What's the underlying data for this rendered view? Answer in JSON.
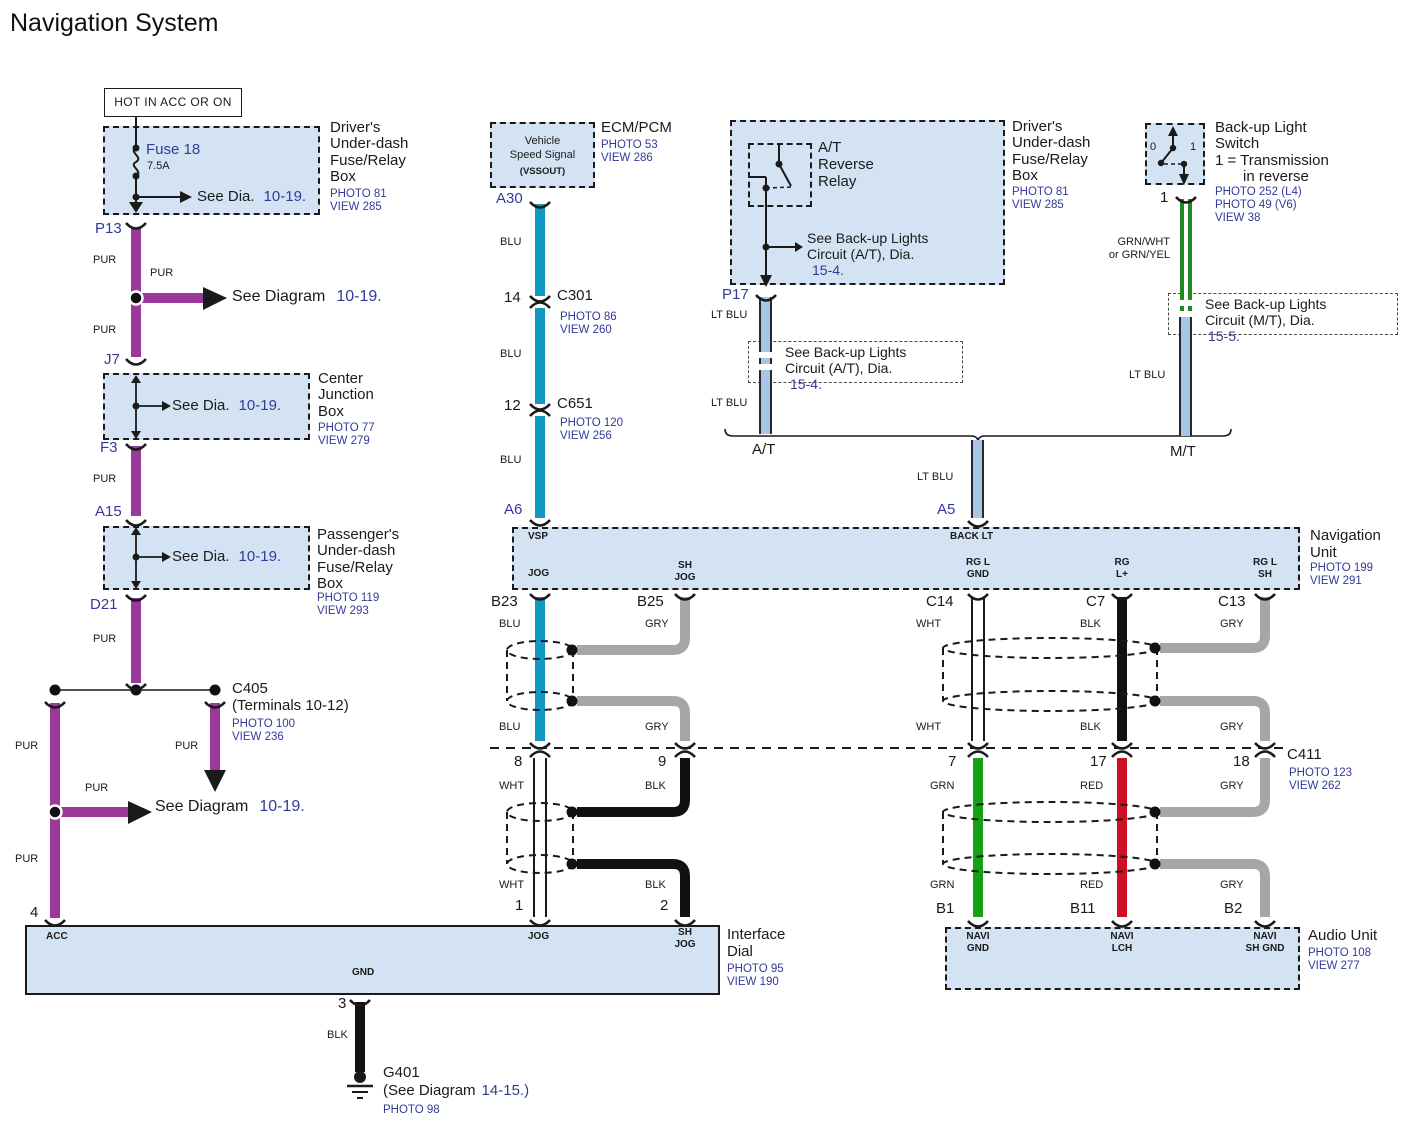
{
  "title": "Navigation System",
  "colors": {
    "box_fill": "#d4e3f3",
    "wire_pur": "#993a9b",
    "wire_blu": "#1099c2",
    "wire_lt_blu": "#a9c6e8",
    "wire_gry": "#a6a6a6",
    "wire_grn": "#16a016",
    "wire_grn_dbl": "#1e8c1e",
    "wire_red": "#cc1122",
    "wire_blk": "#111111",
    "text_blue": "#333a99"
  },
  "wire": {
    "pur": "PUR",
    "blu": "BLU",
    "lt_blu": "LT BLU",
    "gry": "GRY",
    "wht": "WHT",
    "blk": "BLK",
    "grn": "GRN",
    "red": "RED",
    "grn_wht": "GRN/WHT",
    "or_grn_yel": "or GRN/YEL"
  },
  "refs": {
    "see_dia": "See Dia.",
    "see_diagram": "See Diagram",
    "dia_10_19": "10-19.",
    "see_backup": "See Back-up Lights",
    "circuit_at": "Circuit (A/T), Dia.",
    "dia_15_4": "15-4.",
    "circuit_mt": "Circuit (M/T), Dia.",
    "dia_15_5": "15-5."
  },
  "hot": {
    "label": "HOT IN ACC OR ON"
  },
  "fuse": {
    "name": "Fuse 18",
    "rating": "7.5A"
  },
  "driver_box": {
    "l1": "Driver's",
    "l2": "Under-dash",
    "l3": "Fuse/Relay",
    "l4": "Box",
    "photo": "PHOTO 81",
    "view": "VIEW 285"
  },
  "cjb": {
    "l1": "Center",
    "l2": "Junction",
    "l3": "Box",
    "photo": "PHOTO 77",
    "view": "VIEW 279"
  },
  "pass_box": {
    "l1": "Passenger's",
    "l2": "Under-dash",
    "l3": "Fuse/Relay",
    "l4": "Box",
    "photo": "PHOTO 119",
    "view": "VIEW 293"
  },
  "c405": {
    "name": "C405",
    "terms": "(Terminals 10-12)",
    "photo": "PHOTO 100",
    "view": "VIEW 236"
  },
  "vss": {
    "l1": "Vehicle",
    "l2": "Speed Signal",
    "l3": "(VSSOUT)"
  },
  "ecm": {
    "name": "ECM/PCM",
    "photo": "PHOTO 53",
    "view": "VIEW 286"
  },
  "c301": {
    "name": "C301",
    "photo": "PHOTO 86",
    "view": "VIEW 260"
  },
  "c651": {
    "name": "C651",
    "photo": "PHOTO 120",
    "view": "VIEW 256"
  },
  "at_relay": {
    "l1": "A/T",
    "l2": "Reverse",
    "l3": "Relay"
  },
  "bls": {
    "l1": "Back-up Light",
    "l2": "Switch",
    "l3": "1 = Transmission",
    "l4": "in reverse",
    "photo1": "PHOTO 252 (L4)",
    "photo2": "PHOTO 49 (V6)",
    "view": "VIEW 38",
    "pos0": "0",
    "pos1": "1"
  },
  "trans": {
    "at": "A/T",
    "mt": "M/T"
  },
  "nav": {
    "l1": "Navigation",
    "l2": "Unit",
    "photo": "PHOTO 199",
    "view": "VIEW 291",
    "vsp": "VSP",
    "jog": "JOG",
    "sh": "SH",
    "sh_jog": "JOG",
    "back_lt": "BACK LT",
    "rg_l": "RG L",
    "gnd": "GND",
    "rg": "RG",
    "l_plus": "L+",
    "sh_r": "SH"
  },
  "c411": {
    "name": "C411",
    "photo": "PHOTO 123",
    "view": "VIEW 262"
  },
  "dial": {
    "l1": "Interface",
    "l2": "Dial",
    "photo": "PHOTO 95",
    "view": "VIEW 190",
    "acc": "ACC",
    "jog": "JOG",
    "sh": "SH",
    "sh_jog": "JOG",
    "gnd": "GND"
  },
  "audio": {
    "l1": "Audio Unit",
    "photo": "PHOTO 108",
    "view": "VIEW 277",
    "navi": "NAVI",
    "gnd": "GND",
    "lch": "LCH",
    "sh_gnd": "SH GND"
  },
  "g401": {
    "name": "G401",
    "see": "(See Diagram",
    "num": "14-15.)",
    "photo": "PHOTO 98"
  },
  "pins": {
    "p13": "P13",
    "j7": "J7",
    "f3": "F3",
    "a15": "A15",
    "d21": "D21",
    "n4": "4",
    "a30": "A30",
    "n14": "14",
    "n12": "12",
    "a6": "A6",
    "p17": "P17",
    "sw1": "1",
    "a5": "A5",
    "b23": "B23",
    "b25": "B25",
    "c14": "C14",
    "c7": "C7",
    "c13": "C13",
    "n8": "8",
    "n9": "9",
    "n7": "7",
    "n17": "17",
    "n18": "18",
    "n1": "1",
    "n2": "2",
    "n3": "3",
    "b1": "B1",
    "b11": "B11",
    "b2": "B2"
  }
}
